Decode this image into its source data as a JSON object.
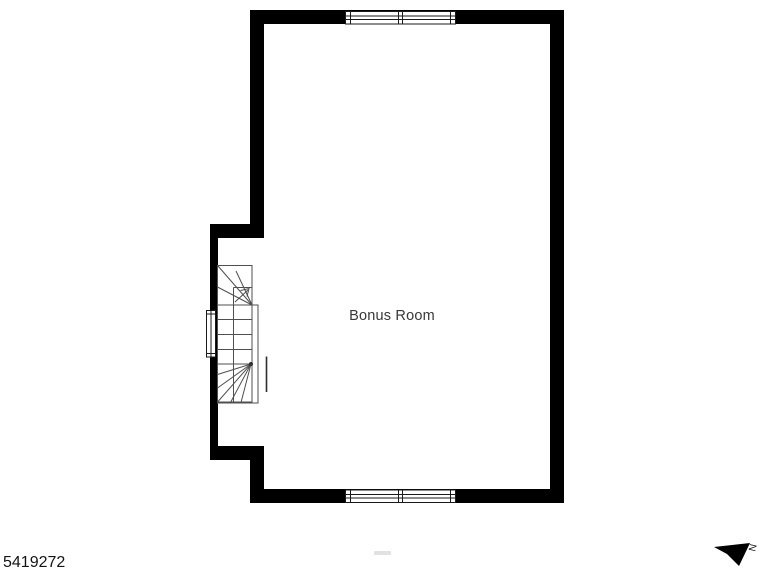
{
  "floorplan": {
    "room_label": "Bonus Room",
    "plan_id": "5419272",
    "compass_label": "N",
    "colors": {
      "wall": "#000000",
      "stair_line": "#4f4f4f",
      "room_label_text": "#383838",
      "plan_id_text": "#141414",
      "watermark": "#c9c9c9"
    }
  }
}
